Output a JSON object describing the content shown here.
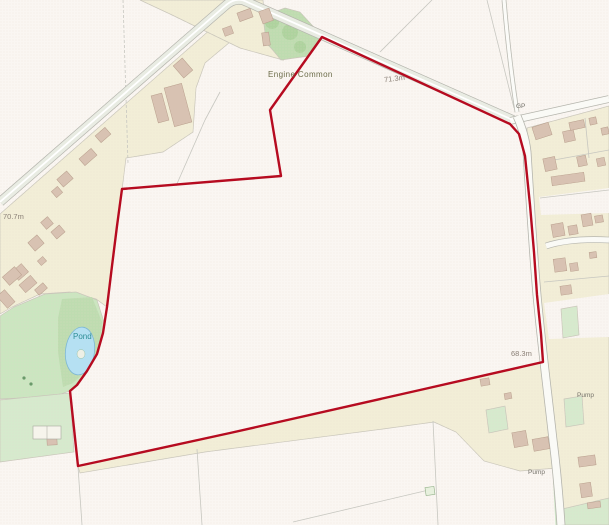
{
  "map": {
    "title": "Site plan - land at Engine Common",
    "style": "ordnance-survey-raster",
    "labels": {
      "engine_common": "Engine Common",
      "spot_height_71": "71.3m",
      "guide_post": "GP",
      "spot_height_70": "70.7m",
      "pond": "Pond",
      "spot_height_68": "68.3m",
      "pump_north": "Pump",
      "pump_south": "Pump"
    },
    "boundary": {
      "color": "#b60b20",
      "points": "322,37 510,124 519,134 525,156 530,205 534,252 537,295 541,334 543,362 420,390 230,433 120,457 78,466 70,391 77,385 87,371 97,354 103,333 107,307 112,266 117,226 122,189 281,176 270,110 322,37"
    },
    "colors": {
      "background": "#faf6f2",
      "dot_texture": "#e3d5cc",
      "parcel_cream": "#f2eed7",
      "green_light": "#cbe6c0",
      "green_mid": "#bedcb0",
      "green_plot": "#d6eacd",
      "pond_blue": "#b5e0f2",
      "building_fill": "#d8c2b2",
      "road_casing": "#b5b5ad",
      "road_fill": "#e9ece3",
      "field_line": "#c7c7c0",
      "boundary_red": "#b60b20",
      "place_text": "#6c6c49",
      "spot_text": "#8b8077",
      "water_text": "#2f8e97"
    }
  }
}
